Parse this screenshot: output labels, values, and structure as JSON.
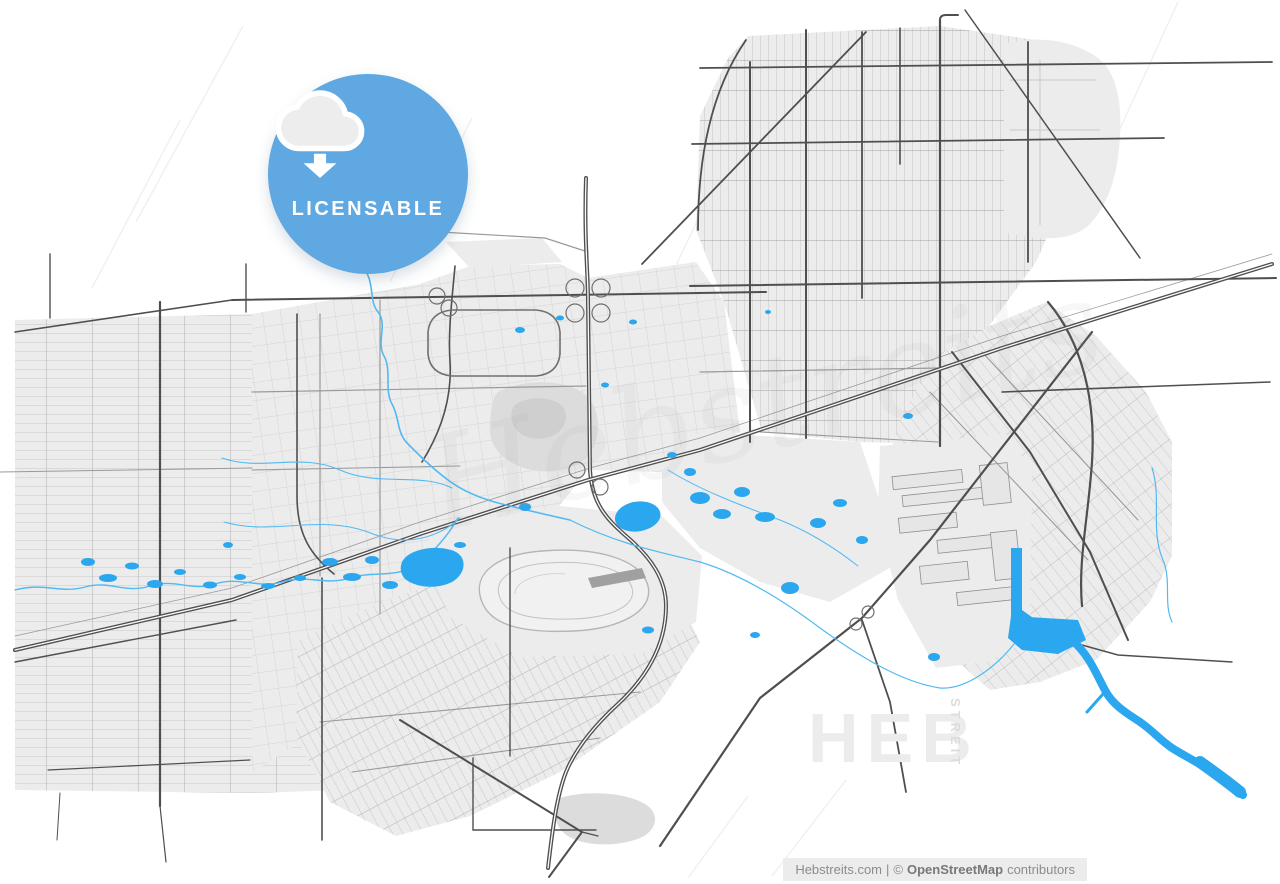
{
  "badge": {
    "label": "LICENSABLE",
    "icon": "cloud-download-icon",
    "background": "#5FA8E2",
    "foreground": "#FFFFFF"
  },
  "watermark": {
    "script_text": "Hebstreits",
    "block_text": "HEB",
    "vertical_text": "STREIT"
  },
  "attribution": {
    "site": "Hebstreits.com",
    "divider": "|",
    "copyright_symbol": "©",
    "organization": "OpenStreetMap",
    "suffix": "contributors"
  },
  "map": {
    "colors": {
      "background": "#FFFFFF",
      "urban_area": "#ECECEC",
      "park": "#DCDCDC",
      "street": "#C9C9C9",
      "secondary_road": "#9A9A9A",
      "major_road": "#4F4F4F",
      "stream": "#52B9F2",
      "water": "#2BA7EF"
    }
  }
}
